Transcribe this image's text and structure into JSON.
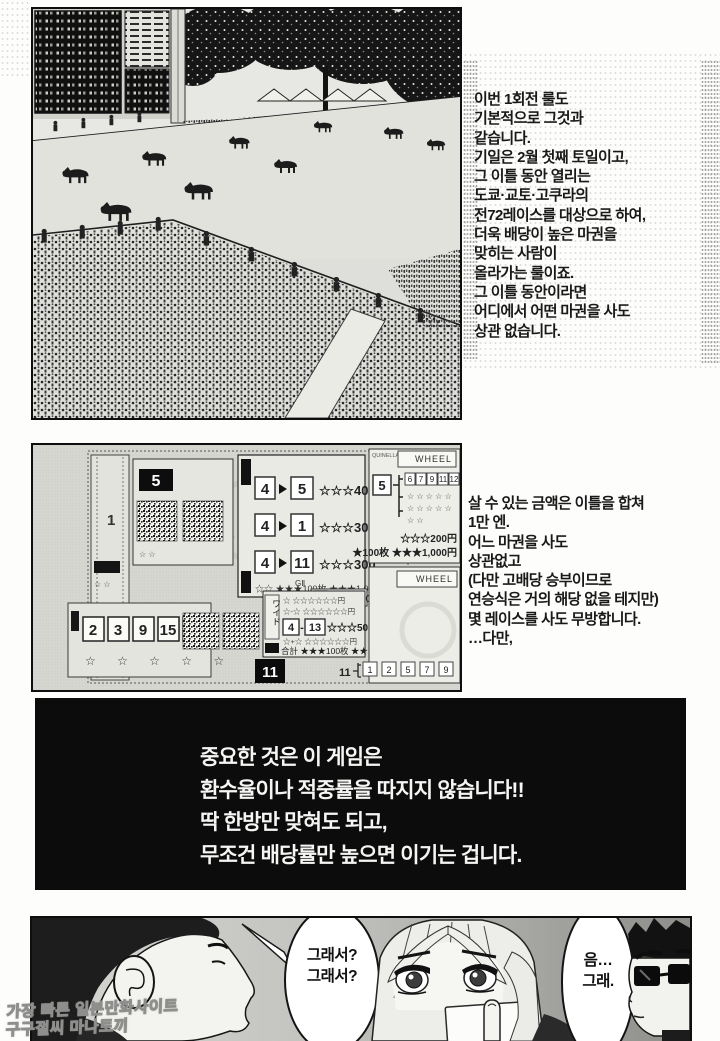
{
  "watermark": {
    "line1": "가장 빠른 일본만화사이트",
    "line2": "구구절씨 마나토끼"
  },
  "panel1": {
    "narration": [
      "이번 1회전 룰도",
      "기본적으로 그것과",
      "같습니다.",
      "기일은 2월 첫째 토일이고,",
      "그 이틀 동안 열리는",
      "도쿄·교토·고쿠라의",
      "전72레이스를 대상으로 하여,",
      "더욱 배당이 높은 마권을",
      "맞히는 사람이",
      "올라가는 룰이죠.",
      "그 이틀 동안이라면",
      "어디에서 어떤 마권을 사도",
      "상관 없습니다."
    ]
  },
  "panel2": {
    "narration": [
      "살 수 있는 금액은 이틀을 합쳐",
      "1만 엔.",
      "어느 마권을 사도",
      "상관없고",
      "(다만 고배당 승부이므로",
      "연승식은 거의 해당 없을 테지만)",
      "몇 레이스를 사도 무방합니다.",
      "…다만,"
    ],
    "tickets": {
      "jra": "JRA",
      "big5": "5",
      "strip1": "1",
      "rows": [
        {
          "a": "4",
          "b": "5",
          "odds": "☆☆☆400"
        },
        {
          "a": "4",
          "b": "1",
          "odds": "☆☆☆300"
        },
        {
          "a": "4",
          "b": "11",
          "odds": "☆☆☆300"
        }
      ],
      "rows_footer": "☆☆ ★★★100枚 ★★★1,000",
      "quinella": "QUINELLA",
      "wheel": "WHEEL",
      "wheel5": {
        "num": "5",
        "n0": "6",
        "n1": "7",
        "n2": "9",
        "n3": "11",
        "n4": "12"
      },
      "stars_row": "☆ ☆ ☆ ☆ ☆",
      "stars_row_short": "☆ ☆",
      "amount200": "☆☆☆200円",
      "amount1000": "★100枚 ★★★1,000円",
      "g2": "GⅡ",
      "ticket3": {
        "num": "3",
        "odds": "☆☆☆500円"
      },
      "t6": {
        "n0": "2",
        "n1": "3",
        "n2": "9",
        "n3": "15",
        "n4": "16",
        "stars": "☆ ☆ ☆ ☆ ☆"
      },
      "wide": {
        "label": "ワイド",
        "row1": "☆ ☆☆☆☆☆☆円",
        "row2": "☆-☆ ☆☆☆☆☆☆円",
        "main_a": "4",
        "main_sep": "-",
        "main_b": "13",
        "main_odds": "☆☆☆500円",
        "row4": "☆+☆ ☆☆☆☆☆☆円",
        "total": "合計 ★★★100枚 ★★★1,000円"
      },
      "big11": "11",
      "wheel11": {
        "num": "11",
        "n0": "1",
        "n1": "2",
        "n2": "5",
        "n3": "7",
        "n4": "9"
      }
    }
  },
  "panel3": {
    "lines": [
      "중요한 것은 이 게임은",
      "환수율이나 적중률을 따지지 않습니다!!",
      "딱 한방만 맞혀도 되고,",
      "무조건 배당률만 높으면 이기는 겁니다."
    ]
  },
  "panel4": {
    "bubble1": {
      "l0": "그래서?",
      "l1": "그래서?"
    },
    "bubble2": {
      "l0": "음…",
      "l1": "그래."
    }
  },
  "colors": {
    "ink": "#111111",
    "paper": "#fdfdfc",
    "panel3_bg": "#0c0c0c"
  }
}
